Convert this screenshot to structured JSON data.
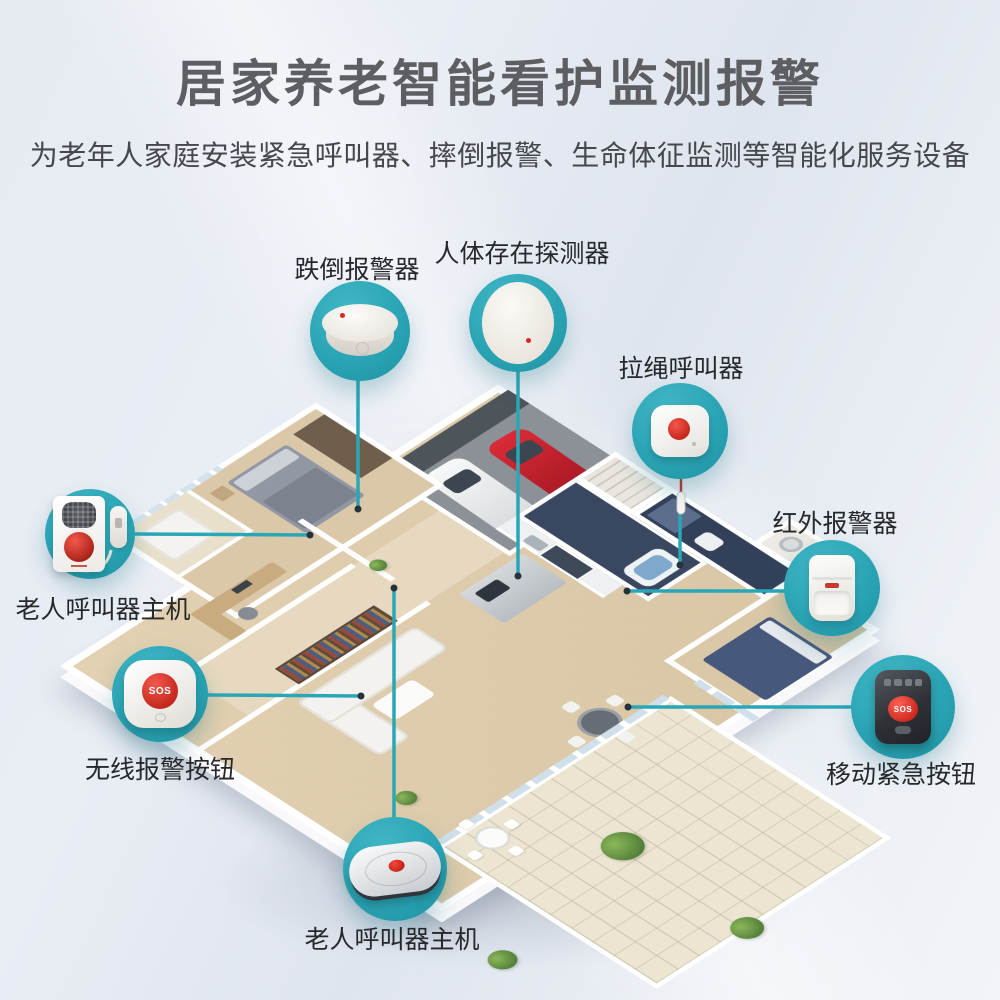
{
  "title": "居家养老智能看护监测报警",
  "subtitle": "为老年人家庭安装紧急呼叫器、摔倒报警、生命体征监测等智能化服务设备",
  "theme": {
    "accent_teal": "#2aa7b6",
    "alert_red": "#d3281e",
    "title_gray": "#5d5e62",
    "label_dark": "#26282b"
  },
  "callouts": [
    {
      "id": "fall-alarm",
      "label": "跌倒报警器"
    },
    {
      "id": "presence-detector",
      "label": "人体存在探测器"
    },
    {
      "id": "pull-cord-caller",
      "label": "拉绳呼叫器"
    },
    {
      "id": "infrared-alarm",
      "label": "红外报警器"
    },
    {
      "id": "mobile-sos-button",
      "label": "移动紧急按钮",
      "button_text": "SOS"
    },
    {
      "id": "caller-host-wall",
      "label": "老人呼叫器主机"
    },
    {
      "id": "wireless-sos-button",
      "label": "无线报警按钮",
      "button_text": "SOS"
    },
    {
      "id": "caller-host-desk",
      "label": "老人呼叫器主机"
    }
  ]
}
